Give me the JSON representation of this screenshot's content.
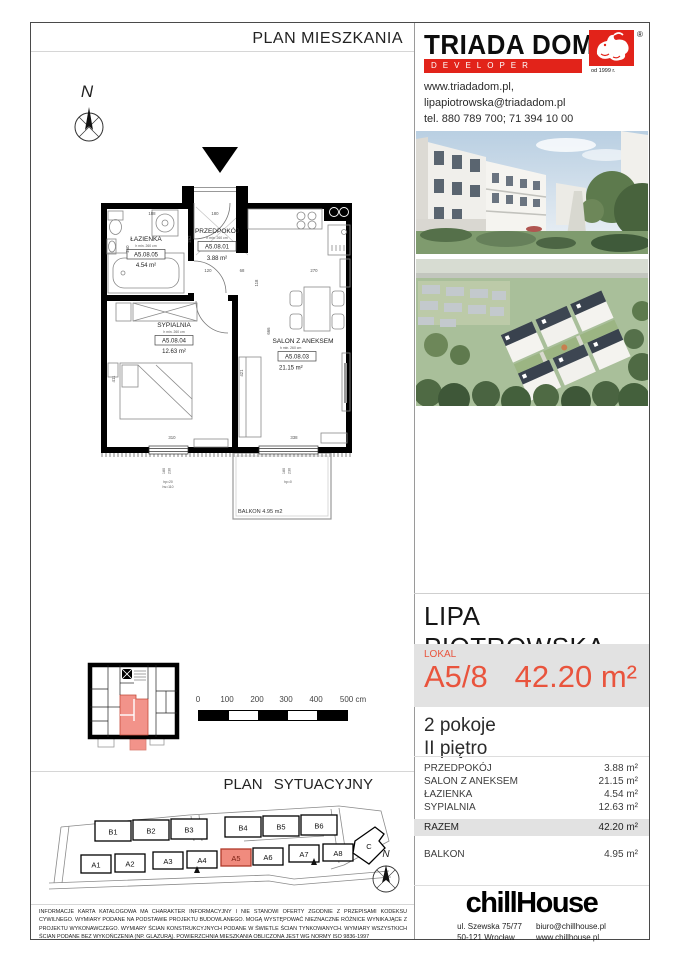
{
  "header": {
    "plan_title": "PLAN MIESZKANIA",
    "site_plan_title": "PLAN SYTUACYJNY"
  },
  "developer": {
    "name": "TRIADA DOM",
    "tagline": "DEVELOPER",
    "since": "od 1999 r.",
    "reg": "®",
    "website": "www.triadadom.pl,",
    "email": "lipapiotrowska@triadadom.pl",
    "phone": "tel. 880 789 700; 71 394 10 00"
  },
  "project": {
    "title": "LIPA PIOTROWSKA",
    "lokal_label": "LOKAL",
    "unit_number": "A5/8",
    "total_area": "42.20 m²",
    "rooms_count": "2 pokoje",
    "floor": "II piętro"
  },
  "floor_plan": {
    "compass_letter": "N",
    "rooms": [
      {
        "name": "ŁAZIENKA",
        "height": "h min. 260 cm",
        "code": "A5.08.05",
        "area": "4.54  m²"
      },
      {
        "name": "PRZEDPOKÓJ",
        "height": "h min. 260 cm",
        "code": "A5.08.01",
        "area": "3.88  m²"
      },
      {
        "name": "SYPIALNIA",
        "height": "h min. 260 cm",
        "code": "A5.08.04",
        "area": "12.63  m²"
      },
      {
        "name": "SALON Z ANEKSEM",
        "height": "h min. 260 cm",
        "code": "A5.08.03",
        "area": "21.15  m²"
      }
    ],
    "balcony_label": "BALKON 4.95 m2",
    "dims": {
      "bath_top": "188",
      "entry_top": "180",
      "hall_w": "120",
      "pass": "68",
      "kitchen_w": "270",
      "kitchen_d": "118",
      "salon_h": "666",
      "hall_h": "262",
      "bath_side": "260",
      "bedroom_side": "411",
      "salon_side": "421",
      "bedroom_window": "310",
      "salon_window": "338"
    },
    "windows": {
      "w1_w": "180",
      "w1_h": "230",
      "w1_hp": "hp=20",
      "w1_hs": "hs=110",
      "w2_w": "180",
      "w2_h": "230",
      "w2_hp": "hp=0"
    }
  },
  "scale_bar": {
    "ticks": [
      "0",
      "100",
      "200",
      "300",
      "400",
      "500 cm"
    ]
  },
  "site_plan": {
    "compass_letter": "N",
    "b_row": [
      "B1",
      "B2",
      "B3",
      "B4",
      "B5",
      "B6"
    ],
    "a_row": [
      "A1",
      "A2",
      "A3",
      "A4",
      "A5",
      "A6",
      "A7",
      "A8"
    ],
    "c_label": "C",
    "highlighted_unit": "A5"
  },
  "area_table": {
    "rows": [
      {
        "label": "PRZEDPOKÓJ",
        "value": "3.88 m²"
      },
      {
        "label": "SALON Z ANEKSEM",
        "value": "21.15 m²"
      },
      {
        "label": "ŁAZIENKA",
        "value": "4.54 m²"
      },
      {
        "label": "SYPIALNIA",
        "value": "12.63 m²"
      }
    ],
    "total_label": "RAZEM",
    "total_value": "42.20 m²",
    "balcony_label": "BALKON",
    "balcony_value": "4.95 m²"
  },
  "agency": {
    "name": "chillHouse",
    "address_line1": "ul. Szewska 75/77",
    "address_line2": "50-121 Wrocław",
    "email": "biuro@chillhouse.pl",
    "website": "www.chillhouse.pl"
  },
  "disclaimer": "INFORMACJE KARTA KATALOGOWA MA CHARAKTER INFORMACYJNY I NIE STANOWI OFERTY ZGODNIE Z PRZEPISAMI KODEKSU CYWILNEGO. WYMIARY PODANE NA PODSTAWIE PROJEKTU BUDOWLANEGO. MOGĄ WYSTĘPOWAĆ NIEZNACZNE RÓŻNICE WYNIKAJĄCE Z PROJEKTU WYKONAWCZEGO. WYMIARY ŚCIAN KONSTRUKCYJNYCH PODANE W ŚWIETLE ŚCIAN TYNKOWANYCH. WYMIARY WSZYSTKICH ŚCIAN PODANE BEZ WYKOŃCZENIA (NP. GLAZURĄ). POWIERZCHNIA MIESZKANIA OBLICZONA JEST WG NORMY ISO 9836-1997",
  "colors": {
    "accent_red": "#e9543d",
    "logo_red": "#e2231a",
    "highlight_salmon": "#f2938a"
  }
}
